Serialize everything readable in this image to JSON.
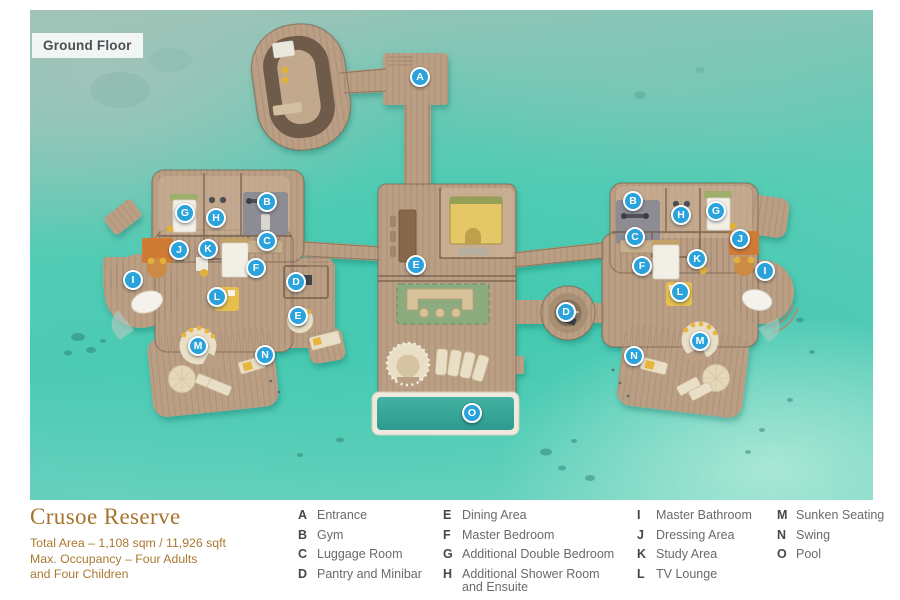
{
  "map": {
    "badge": "Ground Floor",
    "markers": [
      {
        "letter": "A",
        "x": 421,
        "y": 78
      },
      {
        "letter": "E",
        "x": 417,
        "y": 266
      },
      {
        "letter": "D",
        "x": 567,
        "y": 313
      },
      {
        "letter": "O",
        "x": 473,
        "y": 414
      },
      {
        "letter": "B",
        "x": 268,
        "y": 203
      },
      {
        "letter": "G",
        "x": 186,
        "y": 214
      },
      {
        "letter": "H",
        "x": 217,
        "y": 219
      },
      {
        "letter": "C",
        "x": 268,
        "y": 242
      },
      {
        "letter": "J",
        "x": 180,
        "y": 251
      },
      {
        "letter": "K",
        "x": 209,
        "y": 250
      },
      {
        "letter": "F",
        "x": 257,
        "y": 269
      },
      {
        "letter": "I",
        "x": 134,
        "y": 281
      },
      {
        "letter": "D",
        "x": 297,
        "y": 283
      },
      {
        "letter": "L",
        "x": 218,
        "y": 298
      },
      {
        "letter": "E",
        "x": 299,
        "y": 317
      },
      {
        "letter": "M",
        "x": 199,
        "y": 347
      },
      {
        "letter": "N",
        "x": 266,
        "y": 356
      },
      {
        "letter": "B",
        "x": 634,
        "y": 202
      },
      {
        "letter": "H",
        "x": 682,
        "y": 216
      },
      {
        "letter": "G",
        "x": 717,
        "y": 212
      },
      {
        "letter": "C",
        "x": 636,
        "y": 238
      },
      {
        "letter": "J",
        "x": 741,
        "y": 240
      },
      {
        "letter": "K",
        "x": 698,
        "y": 260
      },
      {
        "letter": "F",
        "x": 643,
        "y": 267
      },
      {
        "letter": "I",
        "x": 766,
        "y": 272
      },
      {
        "letter": "L",
        "x": 681,
        "y": 293
      },
      {
        "letter": "M",
        "x": 701,
        "y": 342
      },
      {
        "letter": "N",
        "x": 635,
        "y": 357
      }
    ]
  },
  "legend": {
    "title": "Crusoe Reserve",
    "info_lines": [
      "Total Area – 1,108 sqm / 11,926 sqft",
      "Max. Occupancy – Four Adults",
      "and Four Children"
    ],
    "columns": [
      {
        "items": [
          {
            "letter": "A",
            "label": "Entrance"
          },
          {
            "letter": "B",
            "label": "Gym"
          },
          {
            "letter": "C",
            "label": "Luggage Room"
          },
          {
            "letter": "D",
            "label": "Pantry and Minibar"
          }
        ]
      },
      {
        "items": [
          {
            "letter": "E",
            "label": "Dining Area"
          },
          {
            "letter": "F",
            "label": "Master Bedroom"
          },
          {
            "letter": "G",
            "label": "Additional Double Bedroom"
          },
          {
            "letter": "H",
            "label": "Additional Shower Room\nand Ensuite"
          }
        ]
      },
      {
        "items": [
          {
            "letter": "I",
            "label": "Master Bathroom"
          },
          {
            "letter": "J",
            "label": "Dressing Area"
          },
          {
            "letter": "K",
            "label": "Study Area"
          },
          {
            "letter": "L",
            "label": "TV Lounge"
          }
        ]
      },
      {
        "items": [
          {
            "letter": "M",
            "label": "Sunken Seating"
          },
          {
            "letter": "N",
            "label": "Swing"
          },
          {
            "letter": "O",
            "label": "Pool"
          }
        ]
      }
    ]
  },
  "colors": {
    "marker_blue": "#2aa2db",
    "water_turquoise": "#50cab5",
    "wood_deck": "#bb9f85",
    "pool_teal": "#2d9a8d",
    "title_brown": "#a5732c"
  }
}
